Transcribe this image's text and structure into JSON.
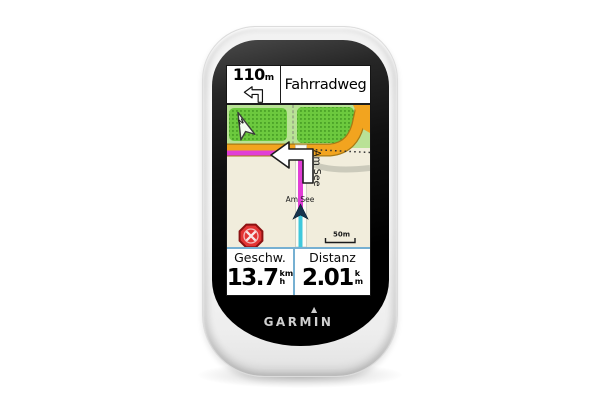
{
  "device": {
    "brand": "GARMIN",
    "brand_delta_icon": "▲"
  },
  "screen": {
    "nav_banner": {
      "distance_value": "110",
      "distance_unit": "m",
      "instruction": "Fahrradweg"
    },
    "map": {
      "street_label": "Am See",
      "street_label2": "Am See",
      "north_label": "N",
      "scale_label": "50m",
      "colors": {
        "ground": "#f1eddc",
        "forest_light": "#b9e296",
        "forest": "#6cc93e",
        "forest_dots": "#459c23",
        "road": "#f2a41f",
        "road_border": "#a87a15",
        "route": "#e13ed6",
        "track": "#3fc8dc",
        "marker": "#16334d",
        "stop_red": "#e23434",
        "divider_blue": "#76b0d2"
      }
    },
    "data_fields": [
      {
        "label": "Geschw.",
        "value": "13.7",
        "unit_top": "km",
        "unit_bottom": "h"
      },
      {
        "label": "Distanz",
        "value": "2.01",
        "unit_top": "k",
        "unit_bottom": "m"
      }
    ]
  }
}
